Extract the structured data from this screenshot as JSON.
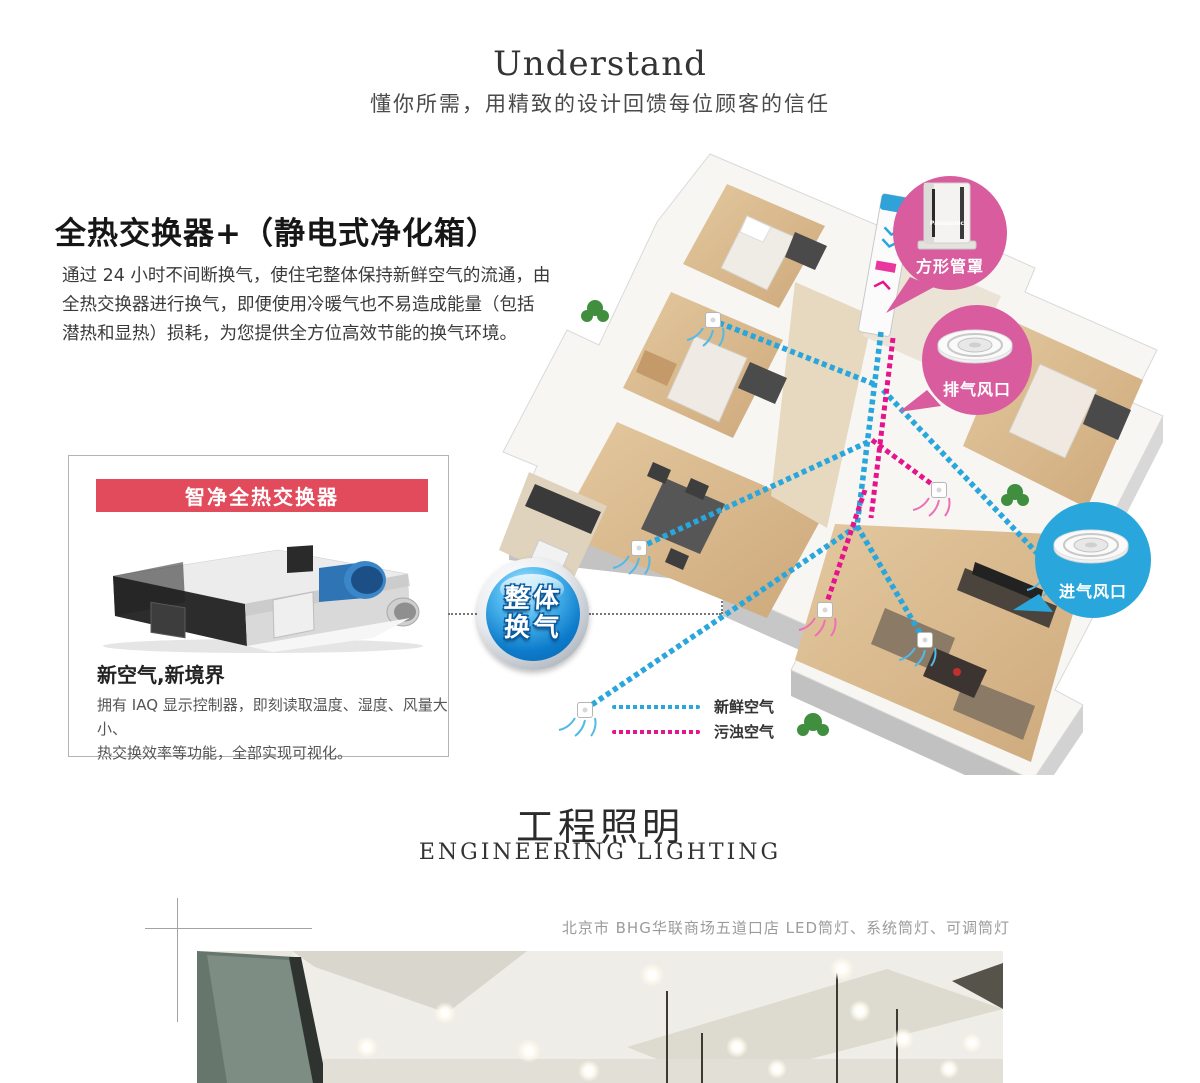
{
  "header": {
    "title": "Understand",
    "subtitle": "懂你所需，用精致的设计回馈每位顾客的信任"
  },
  "exchanger_section": {
    "heading": "全热交换器+（静电式净化箱）",
    "body_lines": [
      "通过 24 小时不间断换气，使住宅整体保持新鲜空气的流通，由",
      "全热交换器进行换气，即便使用冷暖气也不易造成能量（包括",
      "潜热和显热）损耗，为您提供全方位高效节能的换气环境。"
    ],
    "product_card": {
      "banner_label": "智净全热交换器",
      "product_title": "新空气,新境界",
      "desc_lines": [
        "拥有 IAQ 显示控制器，即刻读取温度、湿度、风量大小、",
        "热交换效率等功能，全部实现可视化。"
      ]
    },
    "badge": {
      "line1": "整体",
      "line2": "换气"
    },
    "callouts": {
      "square_duct": {
        "label": "方形管罩",
        "brand": "Panasonic",
        "color": "#d95c9e"
      },
      "exhaust_vent": {
        "label": "排气风口",
        "color": "#d95c9e"
      },
      "intake_vent": {
        "label": "进气风口",
        "color": "#29a7dc"
      }
    },
    "legend": {
      "fresh": {
        "label": "新鲜空气",
        "color": "#29a7dc"
      },
      "dirty": {
        "label": "污浊空气",
        "color": "#e6148c"
      }
    }
  },
  "lighting_section": {
    "title_cn": "工程照明",
    "title_en": "ENGINEERING LIGHTING",
    "caption": "北京市 BHG华联商场五道口店 LED筒灯、系统筒灯、可调筒灯"
  },
  "colors": {
    "banner_red": "#e14b5b",
    "fresh_air_blue": "#29a7dc",
    "dirty_air_magenta": "#e6148c",
    "badge_blue": "#0d7ccb"
  }
}
